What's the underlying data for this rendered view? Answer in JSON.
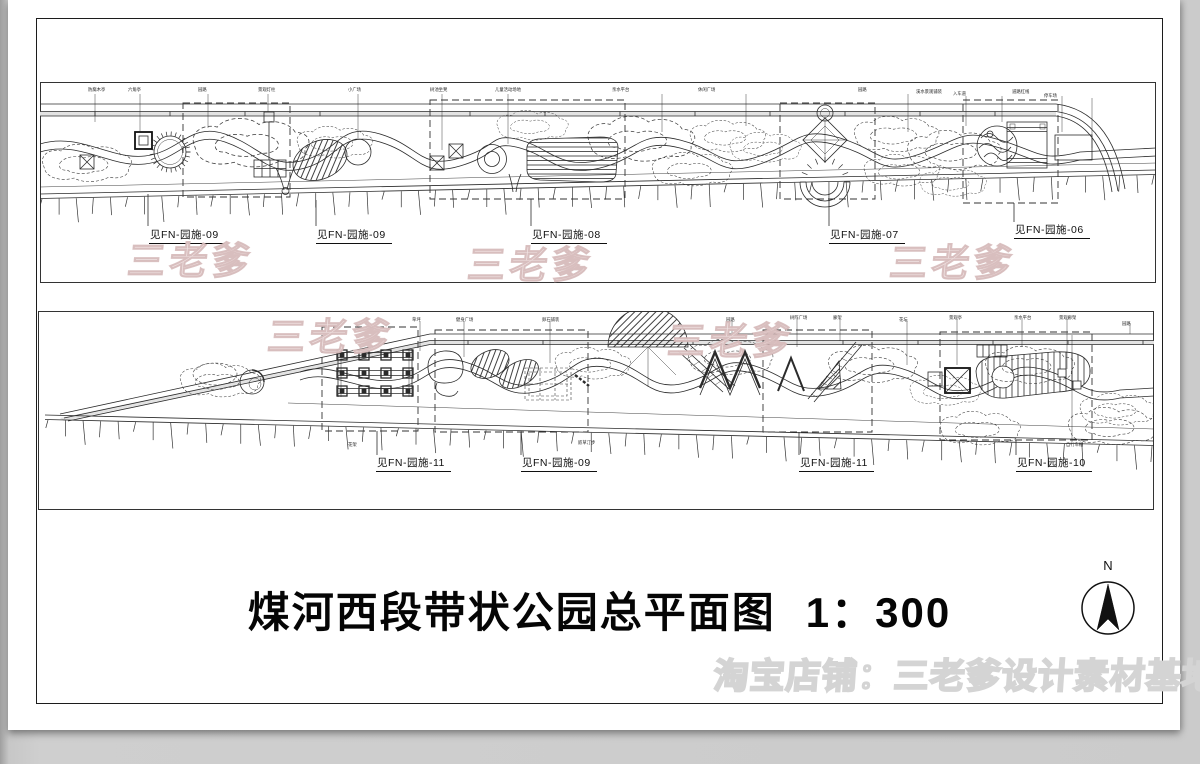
{
  "drawing": {
    "title": "煤河西段带状公园总平面图",
    "scale": "1：300",
    "north_label": "N"
  },
  "watermark": {
    "brand": "三老爹",
    "shop_line": "淘宝店铺：三老爹设计素材基地"
  },
  "top_plan": {
    "callouts": [
      {
        "label": "见FN-园施-09"
      },
      {
        "label": "见FN-园施-09"
      },
      {
        "label": "见FN-园施-08"
      },
      {
        "label": "见FN-园施-07"
      },
      {
        "label": "见FN-园施-06"
      }
    ],
    "tiny_labels": [
      {
        "text": "防腐木亭"
      },
      {
        "text": "六角亭"
      },
      {
        "text": "园路"
      },
      {
        "text": "景观灯柱"
      },
      {
        "text": "小广场"
      },
      {
        "text": "树池坐凳"
      },
      {
        "text": "儿童活动场地"
      },
      {
        "text": "亲水平台"
      },
      {
        "text": "休闲广场"
      },
      {
        "text": "园路"
      },
      {
        "text": "溪水景观铺装"
      },
      {
        "text": "入车道"
      },
      {
        "text": "道路红线"
      },
      {
        "text": "停车场"
      }
    ]
  },
  "bottom_plan": {
    "callouts": [
      {
        "label": "见FN-园施-11"
      },
      {
        "label": "见FN-园施-09"
      },
      {
        "label": "见FN-园施-11"
      },
      {
        "label": "见FN-园施-10"
      }
    ],
    "tiny_labels": [
      {
        "text": "草坪"
      },
      {
        "text": "健身广场"
      },
      {
        "text": "卵石铺装"
      },
      {
        "text": "园路"
      },
      {
        "text": "树阵广场"
      },
      {
        "text": "廊架"
      },
      {
        "text": "花坛"
      },
      {
        "text": "景观亭"
      },
      {
        "text": "亲水平台"
      },
      {
        "text": "景观廊架"
      },
      {
        "text": "园路"
      },
      {
        "text": "花架"
      },
      {
        "text": "嵌草汀步"
      },
      {
        "text": "自行车棚"
      }
    ]
  }
}
